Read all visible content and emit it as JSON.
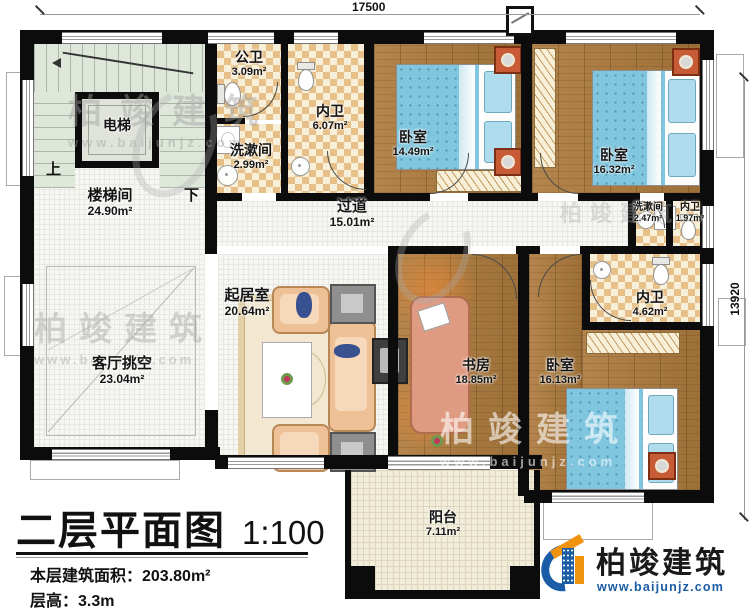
{
  "dimensions": {
    "top": "17500",
    "right": "13920"
  },
  "stairs": {
    "up": "上",
    "down": "下"
  },
  "rooms": {
    "stairwell": {
      "name": "楼梯间",
      "area": "24.90m²"
    },
    "elevator": {
      "name": "电梯"
    },
    "public_bath": {
      "name": "公卫",
      "area": "3.09m²"
    },
    "washroom1": {
      "name": "洗漱间",
      "area": "2.99m²"
    },
    "inner_bath1": {
      "name": "内卫",
      "area": "6.07m²"
    },
    "bedroom1": {
      "name": "卧室",
      "area": "14.49m²"
    },
    "bedroom2": {
      "name": "卧室",
      "area": "16.32m²"
    },
    "hallway": {
      "name": "过道",
      "area": "15.01m²"
    },
    "washroom2": {
      "name": "洗漱间",
      "area": "2.47m²"
    },
    "inner_bath2": {
      "name": "内卫",
      "area": "1.97m²"
    },
    "inner_bath3": {
      "name": "内卫",
      "area": "4.62m²"
    },
    "living_void": {
      "name": "客厅挑空",
      "area": "23.04m²"
    },
    "living_room": {
      "name": "起居室",
      "area": "20.64m²"
    },
    "study": {
      "name": "书房",
      "area": "18.85m²"
    },
    "bedroom3": {
      "name": "卧室",
      "area": "16.13m²"
    },
    "balcony": {
      "name": "阳台",
      "area": "7.11m²"
    }
  },
  "title_block": {
    "title": "二层平面图",
    "scale": "1:100",
    "building_area": "本层建筑面积：203.80m²",
    "floor_height": "层高：3.3m"
  },
  "branding": {
    "name": "柏竣建筑",
    "website": "www.baijunjz.com"
  },
  "colors": {
    "wall": "#0c0c0c",
    "wood_floor": "#a97c44",
    "tile_dark": "#e7c089",
    "tile_light": "#f8efd8",
    "stair_floor": "#dfe6da",
    "bed_blue": "#7fc6de",
    "logo_blue": "#1b5ca6",
    "logo_orange": "#f0940f"
  }
}
